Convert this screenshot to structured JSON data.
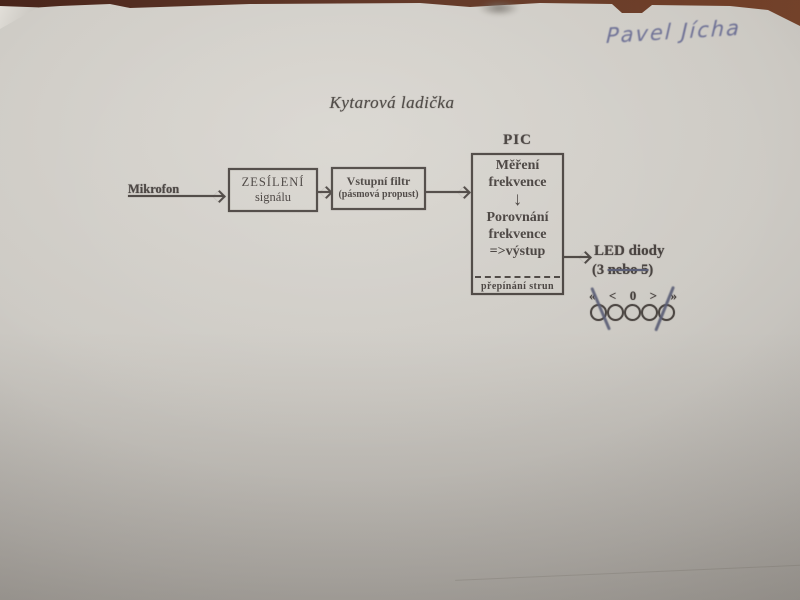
{
  "photo": {
    "handwritten_note": "Pavel Jícha",
    "title": "Kytarová ladička"
  },
  "diagram": {
    "mikrofon_label": "Mikrofon",
    "amplifier": {
      "line1": "ZESÍLENÍ",
      "line2": "signálu"
    },
    "filter": {
      "line1": "Vstupní filtr",
      "line2": "(pásmová propust)"
    },
    "pic": {
      "label": "PIC",
      "step1_line1": "Měření",
      "step1_line2": "frekvence",
      "down_arrow": "↓",
      "step2_line1": "Porovnání",
      "step2_line2": "frekvence",
      "step2_line3": "=>výstup",
      "footer": "přepínání strun"
    },
    "output": {
      "line1": "LED diody",
      "count_prefix": "(3 ",
      "count_struck": "nebo 5",
      "count_suffix": ")"
    },
    "led_display": {
      "symbols": [
        "«",
        "<",
        "0",
        ">",
        "»"
      ],
      "led_count": 5,
      "crossed_out_note": "outer two LEDs crossed out in pen"
    }
  },
  "colors": {
    "ink_print": "#453f3c",
    "pen_blue": "#5a5e7e",
    "paper": "#cdcac4",
    "table_brown": "#5e3420"
  }
}
